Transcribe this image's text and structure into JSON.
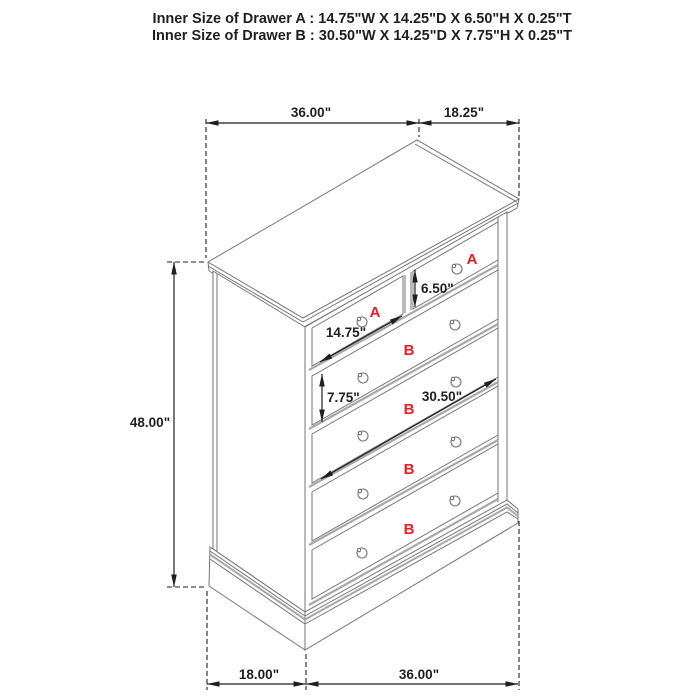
{
  "title": {
    "line1": "Inner Size of Drawer A : 14.75\"W X 14.25\"D X 6.50\"H X 0.25\"T",
    "line2": "Inner Size of Drawer B : 30.50\"W X 14.25\"D X 7.75\"H X 0.25\"T"
  },
  "dimensions": {
    "top_width": "36.00\"",
    "top_depth": "18.25\"",
    "side_height": "48.00\"",
    "bottom_depth": "18.00\"",
    "bottom_width": "36.00\"",
    "drawer_a_inner_height": "6.50\"",
    "drawer_a_inner_width": "14.75\"",
    "drawer_b_inner_height": "7.75\"",
    "drawer_b_inner_width": "30.50\""
  },
  "drawer_labels": {
    "top_left": "A",
    "top_right": "A",
    "row1": "B",
    "row2": "B",
    "row3": "B",
    "row4": "B"
  },
  "colors": {
    "label_red": "#ed1c24",
    "dimension_black": "#1f1f1f",
    "furniture_gray": "#757575",
    "shadow_gray": "#a8a8a8",
    "background": "#ffffff"
  }
}
